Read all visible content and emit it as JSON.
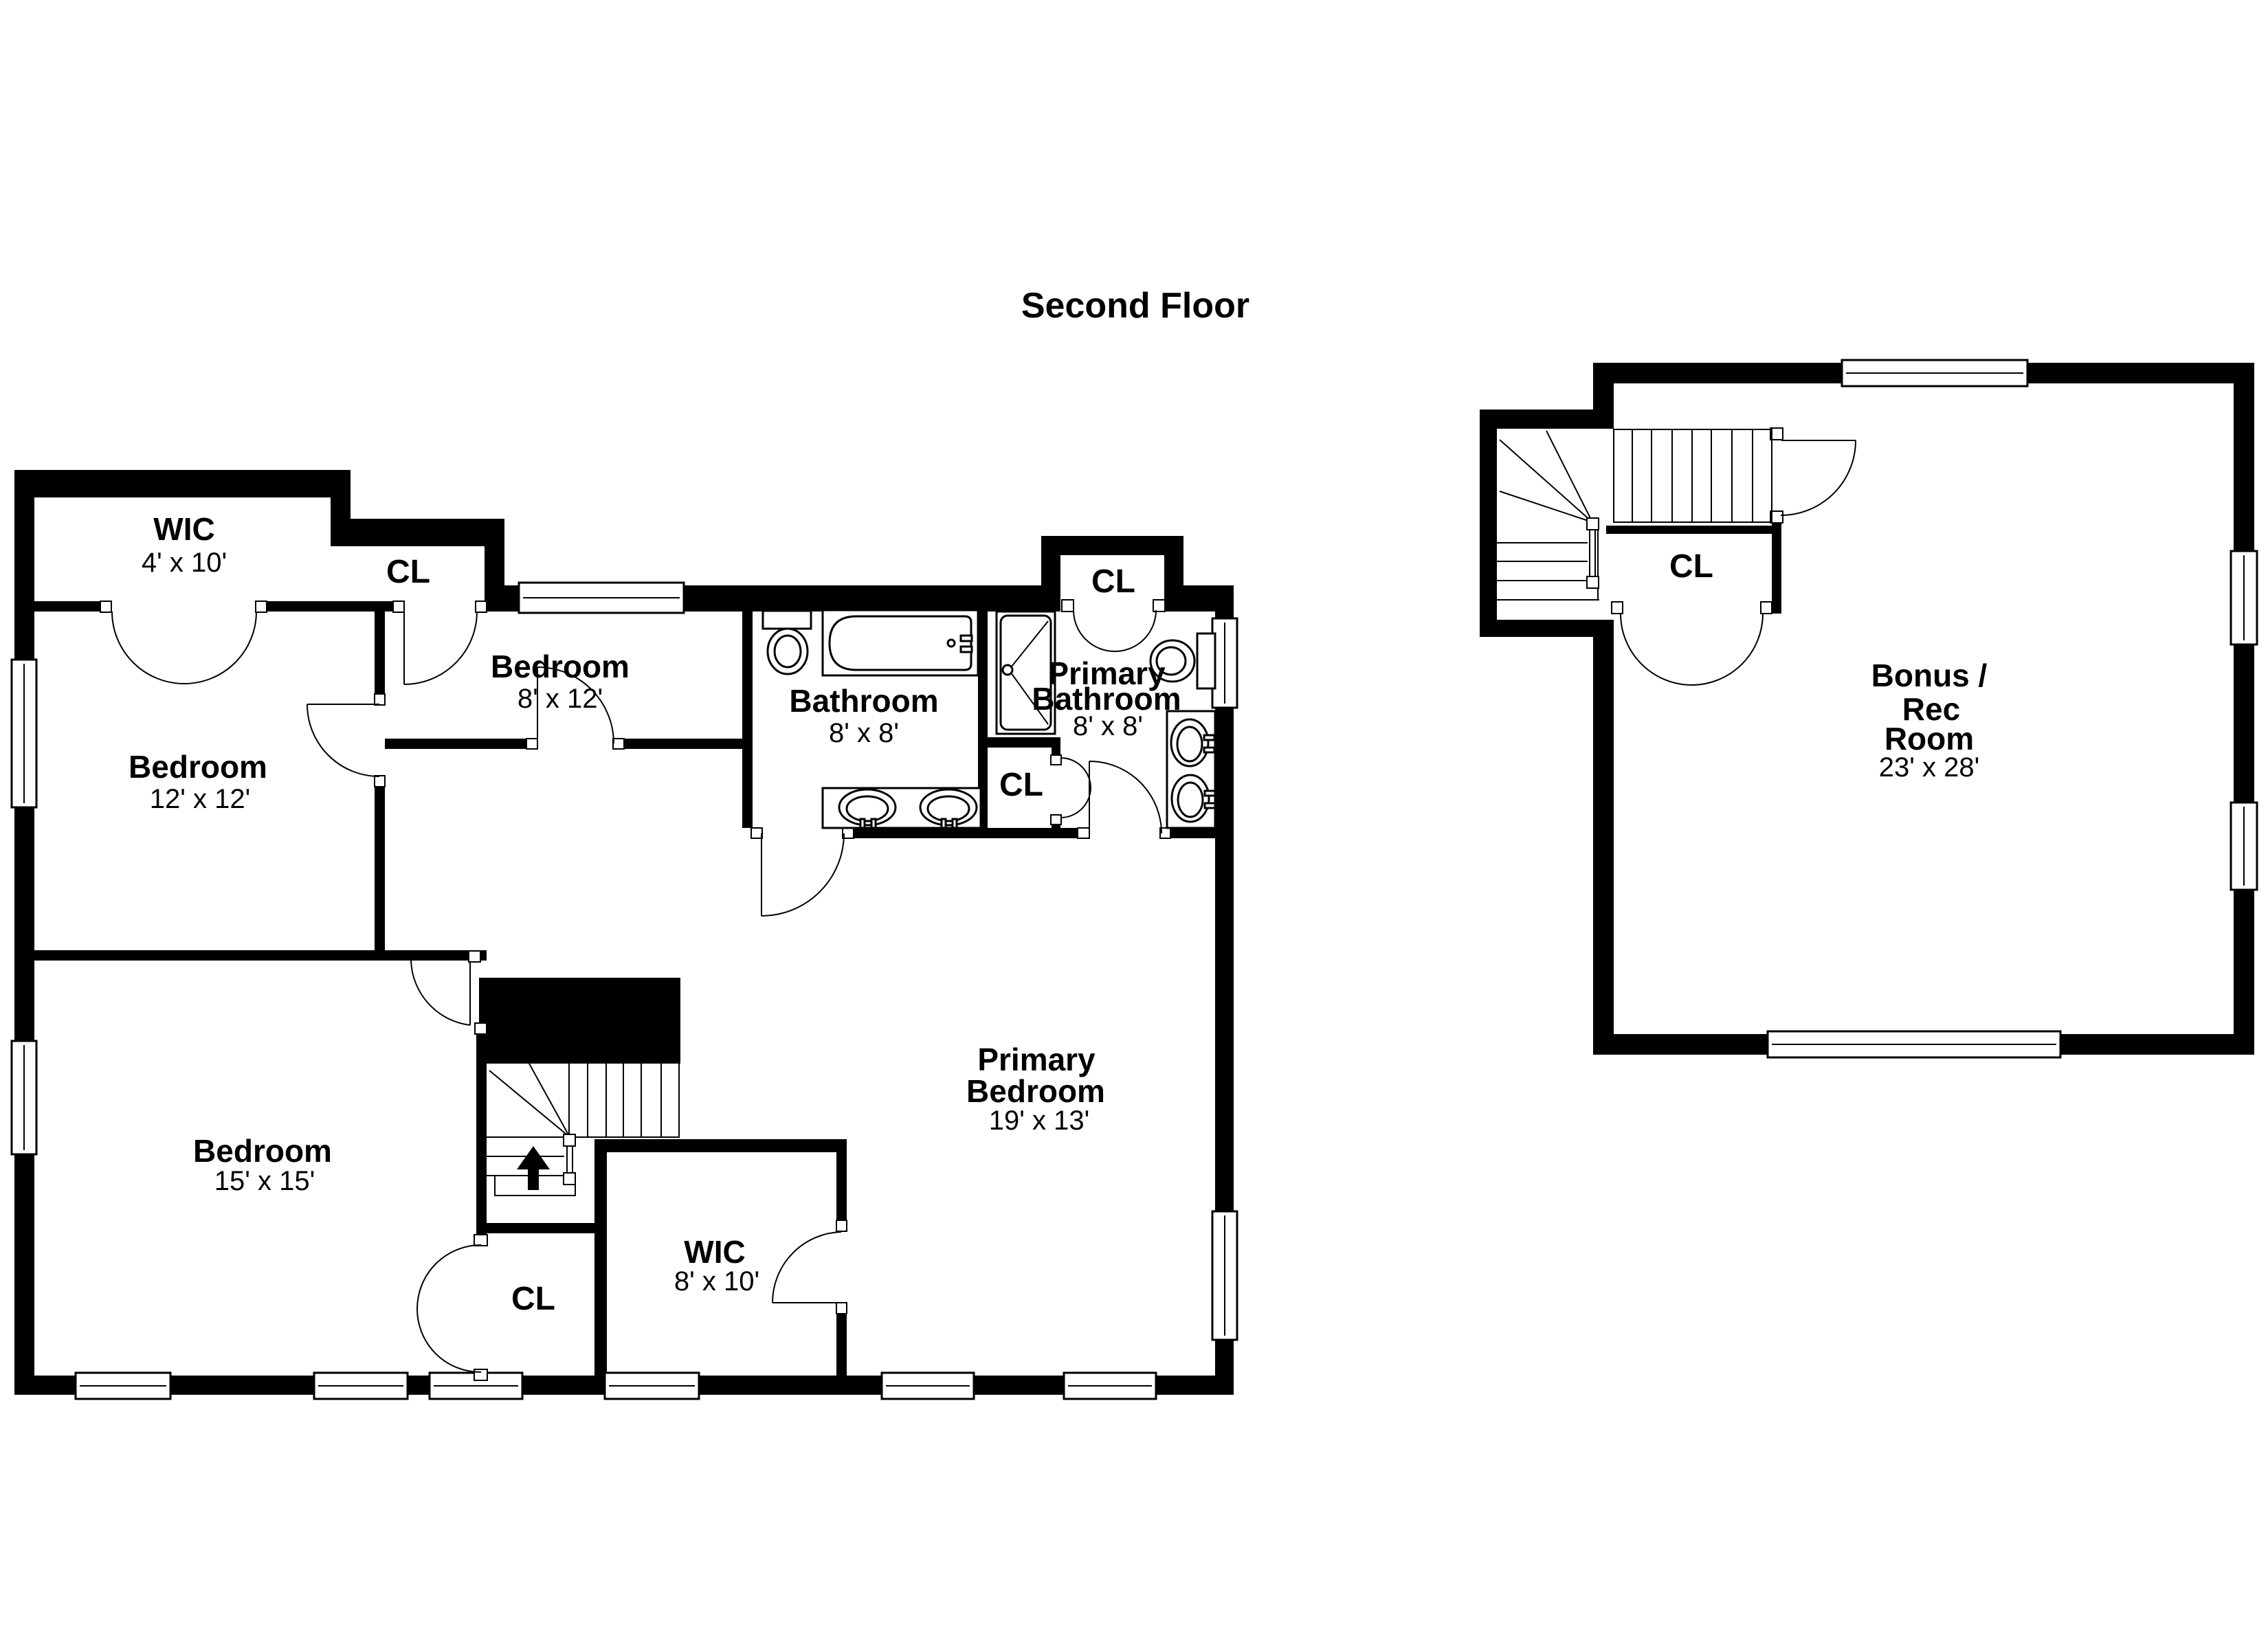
{
  "title": "Second Floor",
  "colors": {
    "wall": "#000000",
    "background": "#ffffff",
    "line": "#000000",
    "text": "#000000"
  },
  "rooms": {
    "wic_top": {
      "name": "WIC",
      "dims": "4' x 10'"
    },
    "cl_top": {
      "name": "CL"
    },
    "bedroom_12": {
      "name": "Bedroom",
      "dims": "12' x 12'"
    },
    "bedroom_8": {
      "name": "Bedroom",
      "dims": "8' x 12'"
    },
    "bathroom": {
      "name": "Bathroom",
      "dims": "8' x 8'"
    },
    "cl_primary": {
      "name": "CL"
    },
    "primary_bathroom": {
      "line1": "Primary",
      "line2": "Bathroom",
      "dims": "8' x 8'"
    },
    "cl_small": {
      "name": "CL"
    },
    "bedroom_15": {
      "name": "Bedroom",
      "dims": "15' x 15'"
    },
    "cl_bottom": {
      "name": "CL"
    },
    "wic_bottom": {
      "name": "WIC",
      "dims": "8' x 10'"
    },
    "primary_bedroom": {
      "line1": "Primary",
      "line2": "Bedroom",
      "dims": "19' x 13'"
    },
    "bonus_room": {
      "line1": "Bonus /",
      "line2": "Rec",
      "line3": "Room",
      "dims": "23' x 28'"
    },
    "cl_bonus": {
      "name": "CL"
    }
  }
}
